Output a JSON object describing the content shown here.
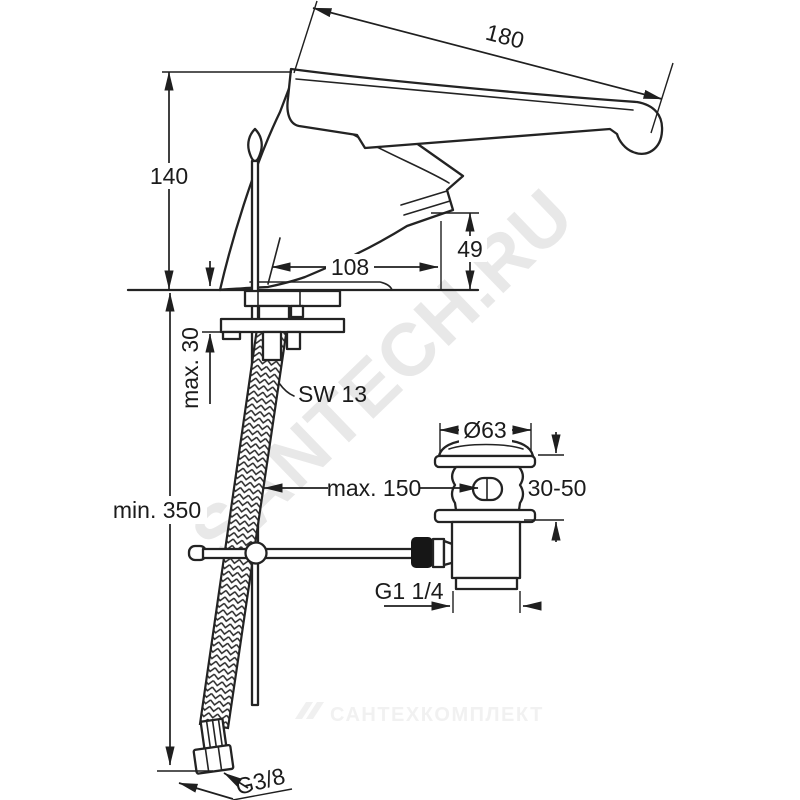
{
  "drawing": {
    "type": "technical installation drawing, basin mixer with pop-up waste",
    "line_color": "#232323",
    "background_color": "#ffffff",
    "watermark_color": "#e8e8e8"
  },
  "watermarks": {
    "diagonal": "SANTECH.RU",
    "footer": "САНТЕХКОМПЛЕКТ"
  },
  "labels": {
    "handle_length": "180",
    "body_height": "140",
    "spout_reach": "108",
    "spout_height": "49",
    "max_deck_thickness": "max. 30",
    "wrench_size": "SW 13",
    "min_hose_length": "min. 350",
    "drain_cap_diameter": "Ø63",
    "max_distance": "max. 150",
    "clamping_range": "30-50",
    "drain_thread": "G1 1/4",
    "supply_thread": "G3/8"
  }
}
